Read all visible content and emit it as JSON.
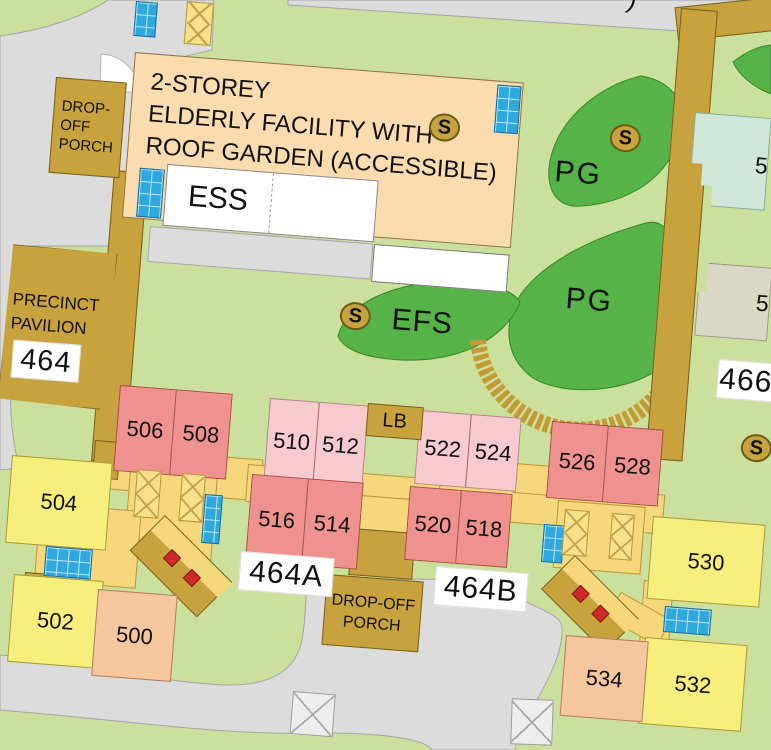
{
  "facility": {
    "line1": "2-STOREY",
    "line2": "ELDERLY FACILITY WITH",
    "line3": "ROOF GARDEN (ACCESSIBLE)"
  },
  "labels": {
    "ess": "ESS",
    "pg": "PG",
    "efs": "EFS",
    "lb": "LB",
    "s": "S",
    "precinct1": "PRECINCT",
    "precinct2": "PAVILION",
    "block_464": "464",
    "block_464a": "464A",
    "block_464b": "464B",
    "block_466": "466",
    "dropoff_top1": "DROP-",
    "dropoff_top2": "OFF",
    "dropoff_top3": "PORCH",
    "dropoff_center1": "DROP-OFF",
    "dropoff_center2": "PORCH",
    "partial_paren": ")",
    "partial_5": "5"
  },
  "units": {
    "u500": "500",
    "u502": "502",
    "u504": "504",
    "u506": "506",
    "u508": "508",
    "u510": "510",
    "u512": "512",
    "u514": "514",
    "u516": "516",
    "u518": "518",
    "u520": "520",
    "u522": "522",
    "u524": "524",
    "u526": "526",
    "u528": "528",
    "u530": "530",
    "u532": "532",
    "u534": "534"
  },
  "colors": {
    "background_green": "#cbe09c",
    "playground_green": "#55b348",
    "road_gray": "#dcdcdc",
    "walkway_brown": "#c7a23d",
    "facility_peach": "#fbdcae",
    "unit_salmon": "#ef918f",
    "unit_lightpink": "#f7cad0",
    "unit_yellow": "#f7ee7d",
    "unit_peach": "#f6c79e",
    "plaza_yellow": "#f7d77c",
    "lift_blue": "#2fa8dd",
    "marker_red": "#cf2b2b",
    "teal_building": "#cfe7d8",
    "beige_building": "#dbd7c6"
  }
}
